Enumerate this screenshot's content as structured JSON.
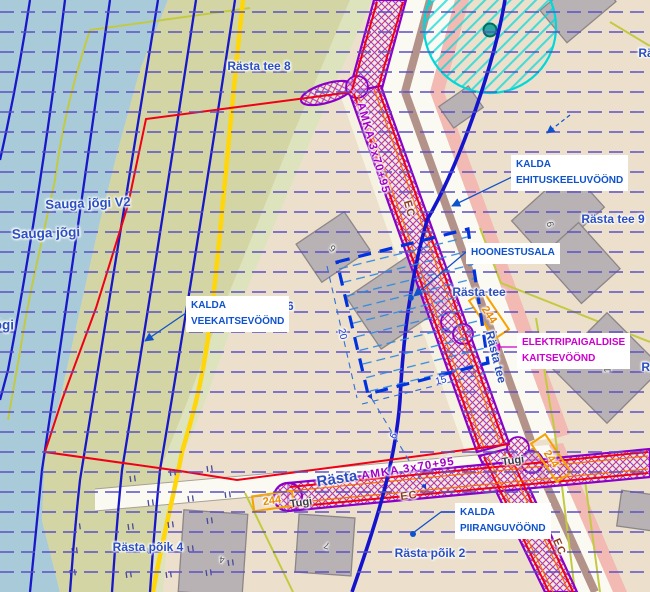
{
  "map": {
    "title": "Detail planning map with shore and utility protection zones",
    "colors": {
      "water": "#a9cbd9",
      "floodplain_khaki": "#d3d5a4",
      "land_tan": "#ece0cc",
      "boundary_red": "#f00016",
      "contour_blue": "#1818c8",
      "dash_blue": "#5b50c6",
      "corridor_purple": "#8a00c8",
      "corridor_hatch_pink": "#d6356e",
      "annotation_blue": "#0f52cc",
      "elektri_magenta": "#cc00cc",
      "road_yellow": "#ffd60a",
      "cadastral_yellow": "#c3ca42",
      "well_zone_cyan": "#00d8d8",
      "marker_orange": "#f5a300"
    },
    "labels": [
      {
        "name": "street-rasta-tee-8",
        "text": "Rästa tee 8",
        "x": 259,
        "y": 66,
        "cls": "st"
      },
      {
        "name": "river-sauga-jogi-v2",
        "text": "Sauga jõgi V2",
        "x": 88,
        "y": 203,
        "rot": -2,
        "cls": "st",
        "size": 13
      },
      {
        "name": "river-sauga-jogi",
        "text": "Sauga jõgi",
        "x": 46,
        "y": 233,
        "rot": -2,
        "cls": "st",
        "size": 13.5
      },
      {
        "name": "river-jogi-clipped",
        "text": "jõgi",
        "x": 2,
        "y": 325,
        "cls": "st",
        "size": 13.5
      },
      {
        "name": "street-rasta-tee-6",
        "text": "Rästa tee 6",
        "x": 262,
        "y": 306,
        "cls": "st"
      },
      {
        "name": "street-rasta-tee-9",
        "text": "Rästa tee 9",
        "x": 613,
        "y": 219,
        "cls": "st"
      },
      {
        "name": "street-rasta-tee",
        "text": "Rästa tee",
        "x": 479,
        "y": 292,
        "cls": "st"
      },
      {
        "name": "street-rasta-tee-along-road",
        "text": "Rästa tee",
        "x": 496,
        "y": 357,
        "rot": 76,
        "cls": "st"
      },
      {
        "name": "street-rasta-poik-4",
        "text": "Rästa põik 4",
        "x": 148,
        "y": 547,
        "cls": "st"
      },
      {
        "name": "street-rasta-poik-2",
        "text": "Rästa põik 2",
        "x": 430,
        "y": 553,
        "cls": "st"
      },
      {
        "name": "street-rasta",
        "text": "Rästa",
        "x": 337,
        "y": 479,
        "rot": -9,
        "cls": "st",
        "size": 15
      },
      {
        "name": "street-ra-clipped-top-right",
        "text": "Rä",
        "x": 646,
        "y": 53,
        "cls": "st"
      },
      {
        "name": "street-ra-clipped-right",
        "text": "Rä",
        "x": 649,
        "y": 367,
        "cls": "st"
      },
      {
        "name": "cable-amka-label-1",
        "text": "AMKA 3x70+95",
        "x": 373,
        "y": 148,
        "rot": 74,
        "cls": "amka"
      },
      {
        "name": "cable-amka-label-2",
        "text": "AMKA 3x70+95",
        "x": 408,
        "y": 469,
        "rot": -9,
        "cls": "amka"
      },
      {
        "name": "cable-ec-label-1",
        "text": "EC",
        "x": 409,
        "y": 209,
        "rot": 74,
        "cls": "ec"
      },
      {
        "name": "cable-ec-label-2",
        "text": "EC",
        "x": 409,
        "y": 496,
        "rot": -8,
        "cls": "ec"
      },
      {
        "name": "cable-ec-label-3",
        "text": "EC",
        "x": 559,
        "y": 547,
        "rot": 66,
        "cls": "ec"
      },
      {
        "name": "pole-tugi-label-1",
        "text": "Tugi",
        "x": 513,
        "y": 461,
        "rot": -8,
        "cls": "tugi"
      },
      {
        "name": "pole-tugi-label-2",
        "text": "Tugi",
        "x": 301,
        "y": 503,
        "rot": -8,
        "cls": "tugi"
      },
      {
        "name": "pole-244-label-a",
        "text": "244",
        "x": 489,
        "y": 315,
        "rot": 56,
        "cls": "n244"
      },
      {
        "name": "pole-244-label-b",
        "text": "244",
        "x": 551,
        "y": 459,
        "rot": 56,
        "cls": "n244"
      },
      {
        "name": "pole-244-label-c",
        "text": "244",
        "x": 272,
        "y": 501,
        "rot": -8,
        "cls": "n244"
      },
      {
        "name": "dimension-20",
        "text": "20",
        "x": 342,
        "y": 334,
        "rot": 77,
        "cls": "dim"
      },
      {
        "name": "dimension-15",
        "text": "15",
        "x": 441,
        "y": 381,
        "rot": -14,
        "cls": "dim"
      },
      {
        "name": "dimension-6",
        "text": "6",
        "x": 394,
        "y": 436,
        "rot": -60,
        "cls": "dim"
      },
      {
        "name": "house-number-9",
        "text": "9",
        "x": 551,
        "y": 224,
        "rot": -105,
        "cls": "house"
      },
      {
        "name": "house-number-6",
        "text": "6",
        "x": 333,
        "y": 248,
        "rot": -140,
        "cls": "house"
      },
      {
        "name": "house-number-4",
        "text": "4",
        "x": 222,
        "y": 559,
        "rot": -175,
        "cls": "house"
      },
      {
        "name": "house-number-7",
        "text": "7",
        "x": 327,
        "y": 545,
        "rot": -160,
        "cls": "house"
      },
      {
        "name": "house-number-1",
        "text": "1",
        "x": 608,
        "y": 370,
        "rot": -90,
        "cls": "house"
      }
    ],
    "callouts": [
      {
        "name": "callout-kalda-veekaitsevoond",
        "lines": [
          "KALDA",
          "VEEKAITSEVÖÖND"
        ],
        "x": 186,
        "y": 296,
        "color": "#0f52cc"
      },
      {
        "name": "callout-kalda-ehituskeeluvoond",
        "lines": [
          "KALDA",
          "EHITUSKEELUVÖÖND"
        ],
        "x": 511,
        "y": 155,
        "color": "#0f52cc"
      },
      {
        "name": "callout-hoonestusala",
        "lines": [
          "HOONESTUSALA"
        ],
        "x": 466,
        "y": 243,
        "color": "#0f52cc"
      },
      {
        "name": "callout-elektripaigaldise-kaitsevoond",
        "lines": [
          "ELEKTRIPAIGALDISE",
          "KAITSEVÖÖND"
        ],
        "x": 517,
        "y": 333,
        "color": "#cc00cc"
      },
      {
        "name": "callout-kalda-piiranguvoond",
        "lines": [
          "KALDA",
          "PIIRANGUVÖÖND"
        ],
        "x": 455,
        "y": 503,
        "color": "#0f52cc"
      }
    ]
  }
}
